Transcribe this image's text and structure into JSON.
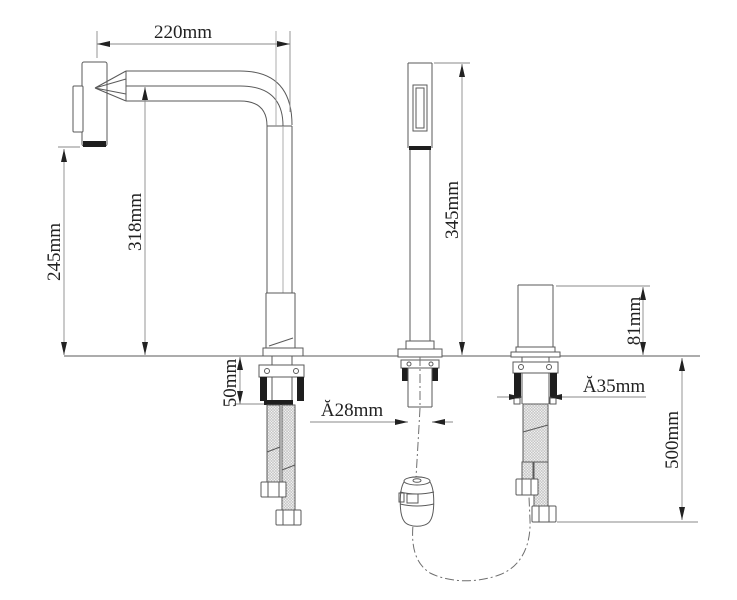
{
  "drawing": {
    "title": "faucet-installation-dimensions",
    "labels": {
      "spout_reach": "220mm",
      "spout_outlet_height": "245mm",
      "spout_underside_height": "318mm",
      "sprayer_height": "345mm",
      "counter_clamp_range": "50mm",
      "sprayer_hole_diameter": "Ă28mm",
      "valve_body_height": "81mm",
      "valve_hole_diameter": "Ă35mm",
      "hose_drop_length": "500mm"
    },
    "colors": {
      "background": "#ffffff",
      "outline": "#5a5a5a",
      "dimension_line": "#8a8a8a",
      "text": "#222222",
      "dark_fill": "#1e1e1e"
    }
  }
}
